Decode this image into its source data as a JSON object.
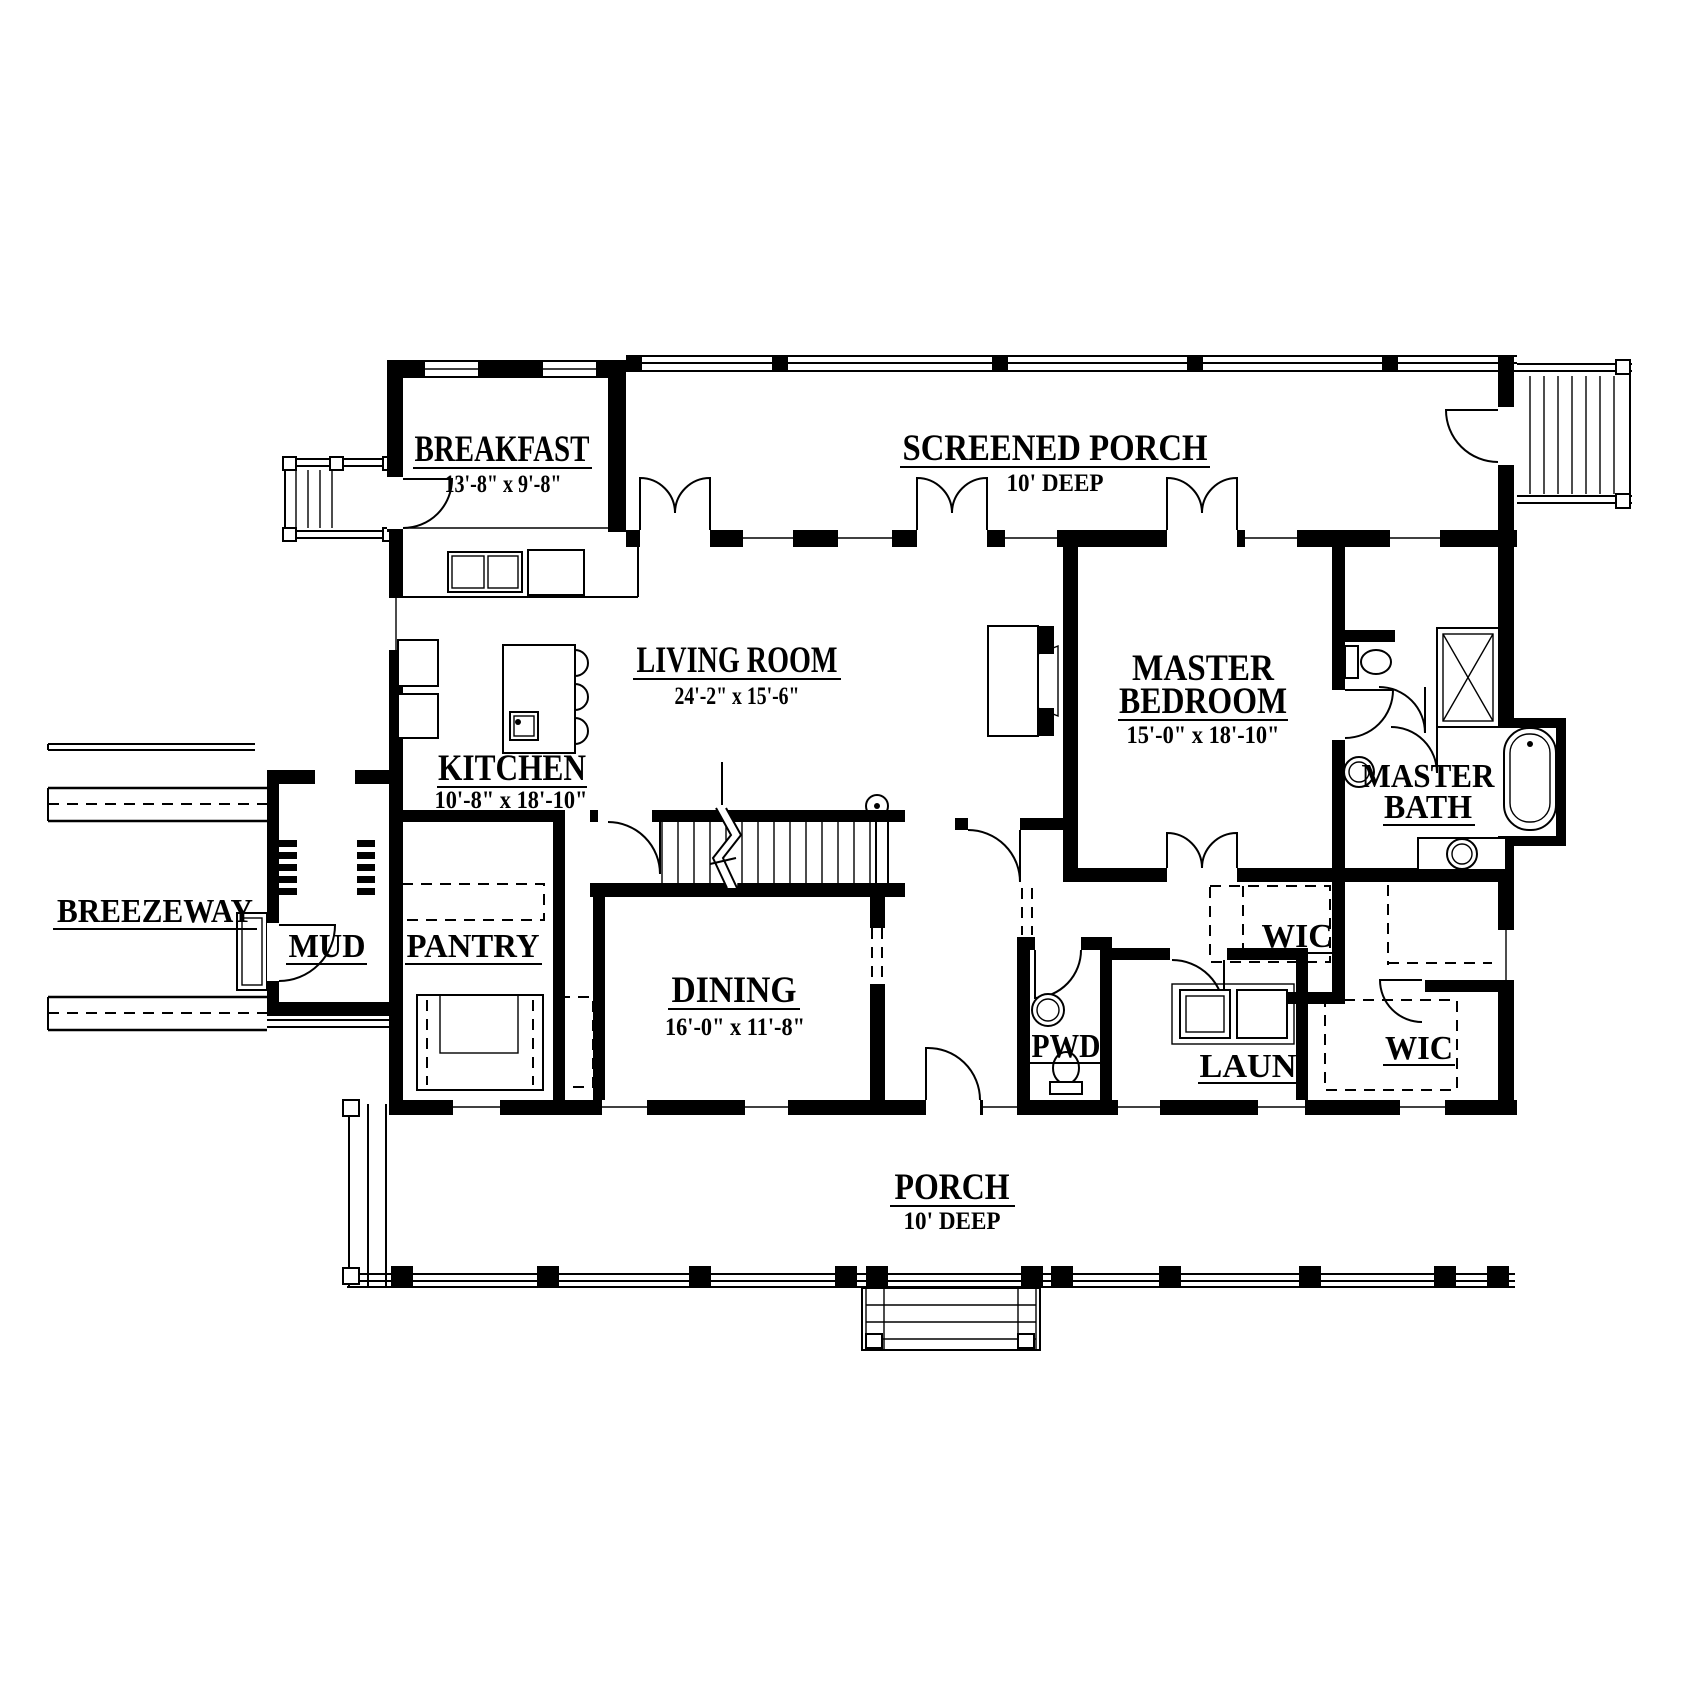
{
  "plan": {
    "type": "floor-plan",
    "colors": {
      "ink": "#000000",
      "paper": "#ffffff"
    },
    "rooms": {
      "breakfast": {
        "name": "BREAKFAST",
        "dims": "13'-8\" x 9'-8\""
      },
      "screened_porch": {
        "name": "SCREENED PORCH",
        "dims": "10' DEEP"
      },
      "living_room": {
        "name": "LIVING ROOM",
        "dims": "24'-2\" x 15'-6\""
      },
      "master_bedroom": {
        "line1": "MASTER",
        "line2": "BEDROOM",
        "dims": "15'-0\" x 18'-10\""
      },
      "kitchen": {
        "name": "KITCHEN",
        "dims": "10'-8\" x 18'-10\""
      },
      "master_bath": {
        "line1": "MASTER",
        "line2": "BATH"
      },
      "breezeway": {
        "name": "BREEZEWAY"
      },
      "mud": {
        "name": "MUD"
      },
      "pantry": {
        "name": "PANTRY"
      },
      "dining": {
        "name": "DINING",
        "dims": "16'-0\" x 11'-8\""
      },
      "wic_upper": {
        "name": "WIC"
      },
      "pwd": {
        "name": "PWD"
      },
      "laundry": {
        "name": "LAUN"
      },
      "wic_lower": {
        "name": "WIC"
      },
      "porch": {
        "name": "PORCH",
        "dims": "10' DEEP"
      }
    }
  }
}
